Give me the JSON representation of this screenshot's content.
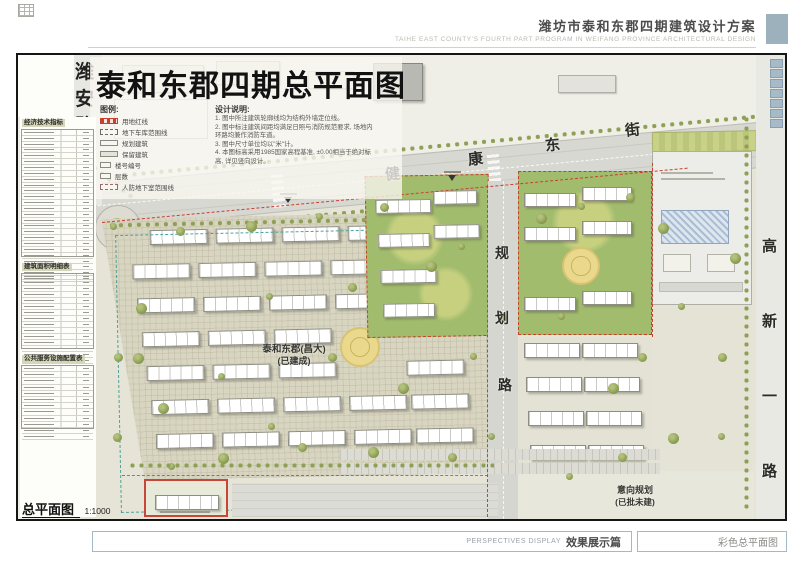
{
  "header": {
    "title": "潍坊市泰和东郡四期建筑设计方案",
    "subtitle": "TAIHE EAST COUNTY'S FOURTH PART PROGRAM IN WEIFANG PROVINCE   ARCHITECTURAL  DESIGN"
  },
  "title_block": {
    "title": "泰和东郡四期总平面图",
    "legend_title": "图例:",
    "legend": [
      {
        "label": "用地红线",
        "type": "red"
      },
      {
        "label": "地下车库范围线",
        "type": "dash"
      },
      {
        "label": "规划建筑",
        "type": "box"
      },
      {
        "label": "保留建筑",
        "type": "boxgray"
      },
      {
        "label": "楼号编号",
        "type": "num"
      },
      {
        "label": "层数",
        "type": "numsm"
      },
      {
        "label": "人防地下室范围线",
        "type": "wide"
      }
    ],
    "notes_title": "设计说明:",
    "notes": [
      "1. 图中所注建筑轮廓线均为结构外墙定位线。",
      "2. 图中标注建筑间距均满足日照与消防规范要求, 场地内环路均兼作消防车道。",
      "3. 图中尺寸单位均以\"米\"计。",
      "4. 本图标高采用1985国家高程基准, ±0.00相当于绝对标高, 详见竖向设计。"
    ]
  },
  "sidebar": {
    "table1_title": "经济技术指标",
    "table2_title": "建筑面积明细表",
    "table3_title": "公共服务设施配置表",
    "scale_label": "总平面图",
    "scale_value": "1:1000"
  },
  "roads": {
    "weian": "潍安路",
    "jiankang": "健康东街",
    "guihua": "规划路",
    "gaoxin": "高新一路"
  },
  "labels": {
    "built_line1": "泰和东郡(昌大)",
    "built_line2": "(已建成)",
    "planned_line1": "意向规划",
    "planned_line2": "(已批未建)"
  },
  "footer": {
    "left_en": "PERSPECTIVES DISPLAY",
    "left_cn": "效果展示篇",
    "right": "彩色总平面图"
  },
  "colors": {
    "boundary_red": "#c8402e",
    "new_phase_green": "#a2bc6e",
    "accent_blue": "#9db1bd",
    "tree_olive": "#8da055"
  }
}
